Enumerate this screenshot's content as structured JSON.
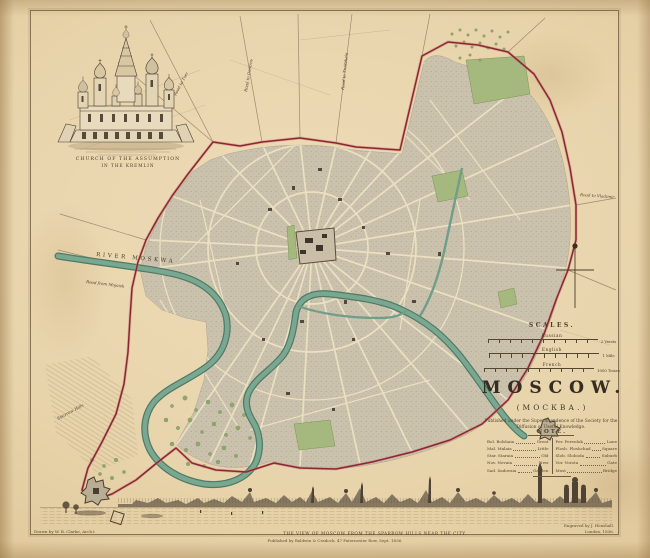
{
  "sheet": {
    "name": "Plan of the City of Moscow"
  },
  "vignette": {
    "caption_line1": "CHURCH OF THE ASSUMPTION",
    "caption_line2": "IN THE KREMLIN"
  },
  "scales": {
    "header": "SCALES.",
    "bars": [
      {
        "label": "Russian",
        "end_label": "2 Versts"
      },
      {
        "label": "English",
        "end_label": "1 Mile"
      },
      {
        "label": "French",
        "end_label": "1000 Toises"
      }
    ]
  },
  "title_block": {
    "title": "MOSCOW.",
    "subtitle": "(МОСКВА.)",
    "publication_line1": "Published under the Superintendence of the Society for the",
    "publication_line2": "Diffusion of Useful Knowledge."
  },
  "note": {
    "header": "NOTE.",
    "columns": [
      {
        "entries": [
          {
            "abbr": "Bol. Bolshaia",
            "meaning": "Great"
          },
          {
            "abbr": "Mal. Malaia",
            "meaning": "Little"
          },
          {
            "abbr": "Star. Staraia",
            "meaning": "Old"
          },
          {
            "abbr": "Nov. Novaia",
            "meaning": "New"
          },
          {
            "abbr": "Sad. Sadovaia",
            "meaning": "Garden"
          }
        ]
      },
      {
        "entries": [
          {
            "abbr": "Per. Pereulok",
            "meaning": "Lane"
          },
          {
            "abbr": "Plosh. Ploshchad",
            "meaning": "Square"
          },
          {
            "abbr": "Slob. Sloboda",
            "meaning": "Suburb"
          },
          {
            "abbr": "Vor. Vorota",
            "meaning": "Gate"
          },
          {
            "abbr": "Most",
            "meaning": "Bridge"
          }
        ]
      }
    ]
  },
  "map_labels": {
    "river": "RIVER MOSKWA",
    "road_mojaisk": "Road from Mojaisk",
    "road_tver": "Road to Tver",
    "road_dmitrov": "Road to Dmitrov",
    "road_troitsa": "Road to Troitzkaia",
    "road_vladimir": "Road to Vladimir",
    "sparrow_hills": "Sparrow Hills"
  },
  "panorama": {
    "caption": "THE VIEW OF MOSCOW FROM THE SPARROW HILLS NEAR THE CITY.",
    "imprint": "Published by Baldwin & Cradock, 47 Paternoster Row, Sept. 1836."
  },
  "credits": {
    "drawn_by": "Drawn by W. B. Clarke, Arch.t",
    "engraved_by": "Engraved by J. Henshall.",
    "engraved_by_line2": "London, 1836."
  },
  "colors": {
    "paper": "#e6d0a5",
    "city_blocks": "#cbc2ad",
    "streets": "#ece0c2",
    "river": "#79a78f",
    "parks": "#a5b87e",
    "boundary": "#8c2731",
    "ink": "#4a3e2f"
  }
}
